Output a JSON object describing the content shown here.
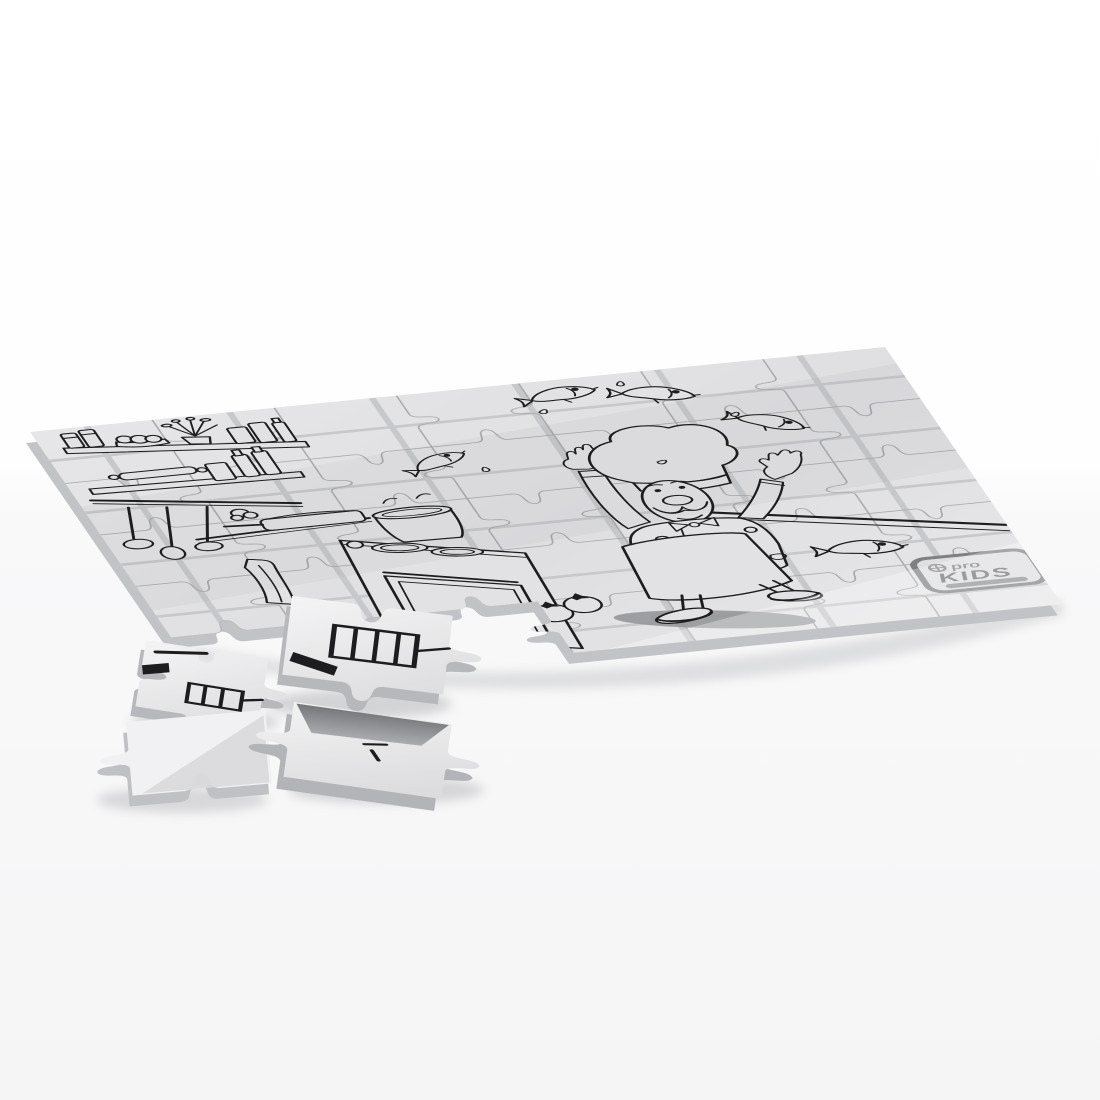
{
  "image": {
    "type": "3d-product-render",
    "subject": "Partially assembled blank coloring jigsaw puzzle lying flat in perspective; black-and-white line artwork of a cartoon chef juggling fish in a kitchen; four loose pieces scattered near the bottom-left corner",
    "background_color": "#ffffff",
    "floor_tint": "#f6f6f7"
  },
  "board": {
    "rows": 5,
    "cols": 7,
    "missing_region": "bottom-left pieces detached",
    "surface_color": "#e2e2e4",
    "surface_color_light": "#e9e9eb",
    "side_color": "#c2c3c6",
    "tile_line_color": "#c7c8cb",
    "cut_line_color": "#a9aaad",
    "art_line_color": "#1d1d1f",
    "shadow_color": "#c9cacc"
  },
  "artwork": {
    "elements": [
      {
        "name": "upper-shelf",
        "items": [
          "jars",
          "bread buns",
          "potted plant",
          "canisters",
          "bottle"
        ]
      },
      {
        "name": "lower-shelf",
        "items": [
          "rolling pin",
          "canister",
          "oil bottles"
        ]
      },
      {
        "name": "hanging-rail",
        "items": [
          "ladle",
          "wooden spoon",
          "skimmer",
          "garlic bunch"
        ]
      },
      {
        "name": "stove",
        "items": [
          "two burners",
          "control knob",
          "oven door",
          "large pot",
          "frying pan",
          "towel"
        ]
      },
      {
        "name": "chef",
        "details": [
          "tall toque hat",
          "mustache",
          "bow tie",
          "double-breasted jacket",
          "apron",
          "raised arms",
          "dark cast shadow"
        ]
      },
      {
        "name": "flying-fish",
        "count": 4
      },
      {
        "name": "counter-fish",
        "count": 1
      },
      {
        "name": "water-droplets",
        "count": 5
      },
      {
        "name": "tomatoes",
        "count": 2
      },
      {
        "name": "counter-edge-lines",
        "count": 2
      }
    ]
  },
  "logo": {
    "prefix": "pro",
    "title": "KIDS",
    "badge_color": "#7f8083",
    "title_color": "#6f7073"
  },
  "loose_pieces": [
    {
      "name": "stove-base-piece",
      "art": "oven vent grille and stove leg lines"
    },
    {
      "name": "vent-piece",
      "art": "vent grille and line fragments"
    },
    {
      "name": "blank-corner-piece",
      "art": "blank with diagonal sheen"
    },
    {
      "name": "tilted-piece",
      "art": "line fragments, dark tilted face"
    }
  ]
}
